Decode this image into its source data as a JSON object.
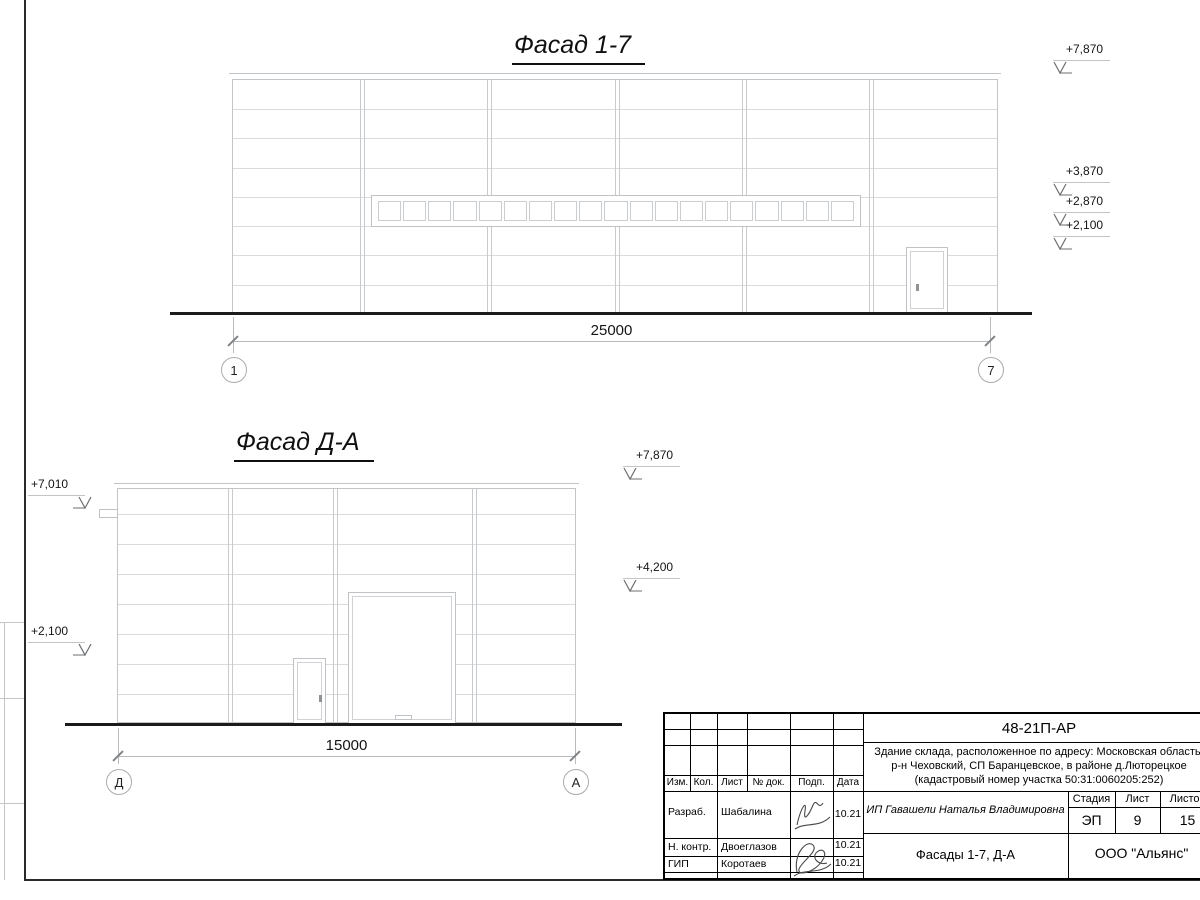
{
  "sheet": {
    "facade1": {
      "title": "Фасад 1-7",
      "dimension": "25000",
      "axis_left": "1",
      "axis_right": "7",
      "elevations": [
        "+7,870",
        "+3,870",
        "+2,870",
        "+2,100"
      ]
    },
    "facade2": {
      "title": "Фасад Д-А",
      "dimension": "15000",
      "axis_left": "Д",
      "axis_right": "А",
      "elev_left": [
        "+7,010",
        "+2,100"
      ],
      "elev_right": [
        "+7,870",
        "+4,200"
      ]
    },
    "titleblock": {
      "doc_number": "48-21П-АР",
      "desc1": "Здание склада, расположенное по адресу: Московская область,",
      "desc2": "р-н Чеховский, СП Баранцевское, в районе д.Люторецкое",
      "desc3": "(кадастровый номер участка 50:31:0060205:252)",
      "client": "ИП Гавашели Наталья Владимировна",
      "object_title": "Фасады 1-7, Д-А",
      "company": "ООО \"Альянс\"",
      "stage_label": "Стадия",
      "stage": "ЭП",
      "sheet_label": "Лист",
      "sheet_num": "9",
      "sheets_label": "Листов",
      "sheets_total": "15",
      "cols": [
        "Изм.",
        "Кол.",
        "Лист",
        "№ док.",
        "Подп.",
        "Дата"
      ],
      "rows": [
        {
          "role": "Разраб.",
          "name": "Шабалина",
          "date": "10.21"
        },
        {
          "role": "Н. контр.",
          "name": "Двоеглазов",
          "date": "10.21"
        },
        {
          "role": "ГИП",
          "name": "Коротаев",
          "date": "10.21"
        }
      ]
    }
  }
}
